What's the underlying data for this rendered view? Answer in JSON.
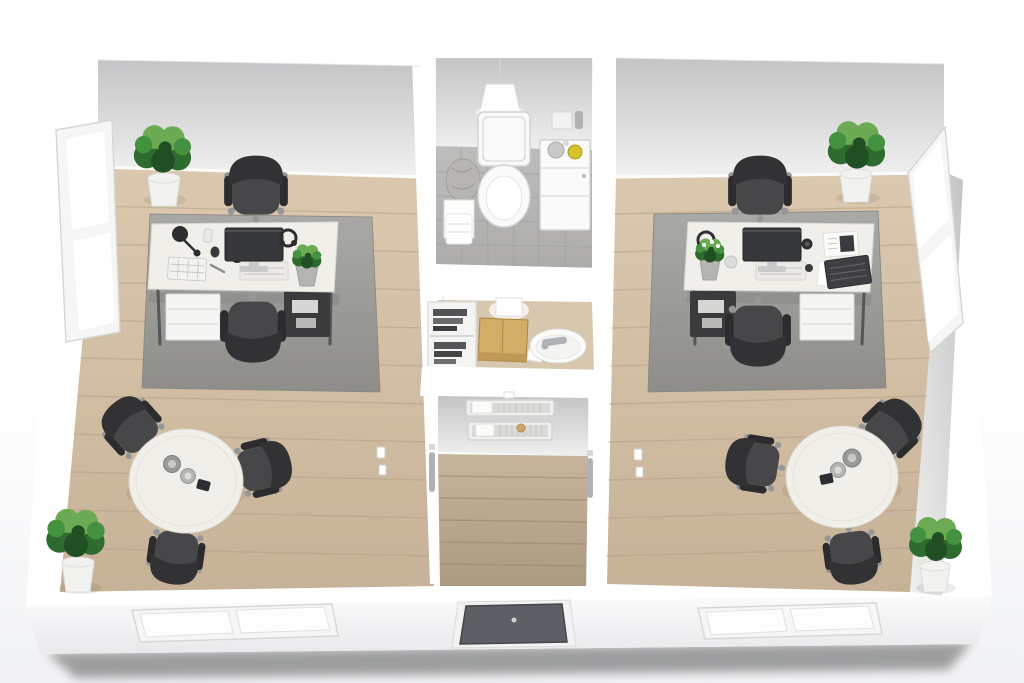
{
  "meta": {
    "description": "3D rendered top-down cutaway floor plan of a small office suite: two mirrored office rooms flanking a central core (bathroom, storage room, entrance hallway).",
    "view": "isometric top-down cutaway, no visible text in image"
  },
  "palette": {
    "wall_white": "#ffffff",
    "wallface_top": "#c4c4c6",
    "wallface_bottom": "#f0f0ef",
    "front_top": "#fbfbfc",
    "front_bottom": "#e9e9ec",
    "ground_shadow": "#dfe0e3",
    "wood_light": "#dbc9af",
    "wood_dark": "#c6b297",
    "plank_line": "#b3a084",
    "hall_light": "#c6b59c",
    "hall_dark": "#ab9a82",
    "hall_line": "#96876f",
    "rug_light": "#a8a8a5",
    "rug_dark": "#8c8c89",
    "tile_light": "#bebdbb",
    "tile_dark": "#adacaa",
    "tile_line": "#a2a19f",
    "chair_seat": "#47474a",
    "chair_back": "#323234",
    "chair_arm": "#2c2c2e",
    "chair_base": "#97979a",
    "desk_top": "#f1efe9",
    "desk_edge": "#dbd8d0",
    "desk_leg": "#55555a",
    "drawer": "#f5f5f3",
    "drawer_line": "#dcdcda",
    "undershelf": "#3b3b3e",
    "screen": "#35373a",
    "screen_edge": "#232426",
    "stand": "#c9c9cb",
    "keyboard": "#f2f2f0",
    "key_line": "#c6c6c4",
    "dark_item": "#2e2e30",
    "plant_dark": "#2e6b2f",
    "plant_mid": "#449140",
    "plant_light": "#6cab54",
    "plant_deep": "#1f4f22",
    "pot_white": "#f2f2f0",
    "pot_rim": "#dededc",
    "pot_gray": "#b4b4b2",
    "white_fix": "#fafafa",
    "fix_line": "#d2d2d0",
    "chrome": "#aeb2b5",
    "box_top": "#d2ad68",
    "box_side": "#bd9452",
    "accent_yellow": "#d6c22e",
    "door_panel": "#5c6064",
    "door_dark": "#43464a"
  },
  "scene": {
    "building": {
      "walls": "white cutaway walls",
      "shape": "rectangular suite viewed from above"
    },
    "rooms": [
      {
        "name": "office-left",
        "floor": "light oak planks",
        "items": [
          "corner plant top-left",
          "tall 2-pane window on left wall",
          "white desk",
          "desk lamp",
          "keyboard",
          "smartphone",
          "mouse",
          "speaker puck",
          "monitor with dock",
          "desk plant",
          "headphones",
          "drawer unit",
          "under-desk shelf",
          "office chair top",
          "office chair bottom",
          "gray area rug",
          "round meeting table",
          "carafe and cups",
          "conference chairs x3",
          "corner plant bottom-left",
          "light switches x2"
        ]
      },
      {
        "name": "bathroom",
        "floor": "gray ceramic tile",
        "items": [
          "pendant lamp",
          "toilet",
          "storage cabinet with jar and yellow bottle",
          "wall dispenser",
          "side table with towel",
          "laundry bag"
        ]
      },
      {
        "name": "storage-room",
        "floor": "light oak",
        "items": [
          "open shelf with binders",
          "cardboard box",
          "round basin with chrome faucet",
          "wall light"
        ]
      },
      {
        "name": "hallway",
        "floor": "oak planks",
        "items": [
          "wall shelf upper",
          "wall shelf lower",
          "small wall lamp",
          "door handle left",
          "door handle right",
          "entry door in front wall"
        ]
      },
      {
        "name": "office-right",
        "floor": "light oak planks",
        "items": [
          "corner plant top-right",
          "tall 2-pane window on right wall",
          "white desk",
          "headphones",
          "desk plant with white blossoms",
          "jar",
          "monitor with dock",
          "speaker pucks x2",
          "notepad calculator",
          "laptop",
          "paper sheet",
          "under-desk shelf",
          "drawer unit",
          "office chair top",
          "office chair bottom",
          "gray area rug",
          "round meeting table",
          "carafe and cups",
          "conference chairs x3",
          "corner plant bottom-right",
          "light switches x2"
        ]
      }
    ],
    "exterior": {
      "front_windows": [
        "left pair of angled panes",
        "right pair of angled panes"
      ],
      "entry_door": "dark gray door centered in front wall",
      "side_windows": [
        "left wall window",
        "right wall window"
      ]
    },
    "counts": {
      "desks": 2,
      "round_tables": 2,
      "office_chairs": 4,
      "conference_chairs": 6,
      "plants": 6,
      "windows": 4
    }
  }
}
